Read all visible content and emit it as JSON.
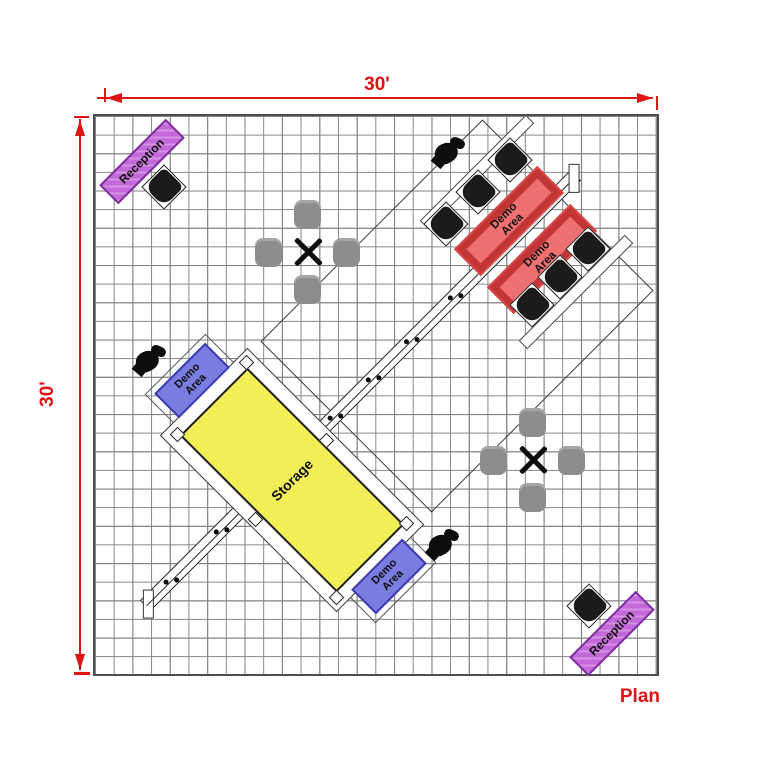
{
  "plan": {
    "title_label": "Plan",
    "dimension_top": "30'",
    "dimension_left": "30'",
    "grid_feet": 30,
    "grid_cell_feet": 1
  },
  "areas": {
    "storage": {
      "label": "Storage",
      "fill": "#f1ee58"
    },
    "reception_nw": {
      "label": "Reception",
      "fill": "#c469d9"
    },
    "reception_se": {
      "label": "Reception",
      "fill": "#c469d9"
    },
    "demo_west": {
      "label": "Demo Area",
      "fill": "#7b7ce0"
    },
    "demo_south": {
      "label": "Demo Area",
      "fill": "#7b7ce0"
    },
    "demo_ne_1": {
      "label": "Demo Area",
      "fill": "#ef7070"
    },
    "demo_ne_2": {
      "label": "Demo Area",
      "fill": "#ef7070"
    }
  },
  "furniture": {
    "table_groups": 2,
    "gray_chairs": 8,
    "black_chairs": 8,
    "podiums": 3,
    "truss_lights": 12
  },
  "colors": {
    "dimension_red": "#dd1414",
    "grid_line": "#858585",
    "storage_yellow": "#f1ee58",
    "demo_red": "#ef7070",
    "demo_blue": "#7b7ce0",
    "reception_purple": "#c469d9"
  }
}
